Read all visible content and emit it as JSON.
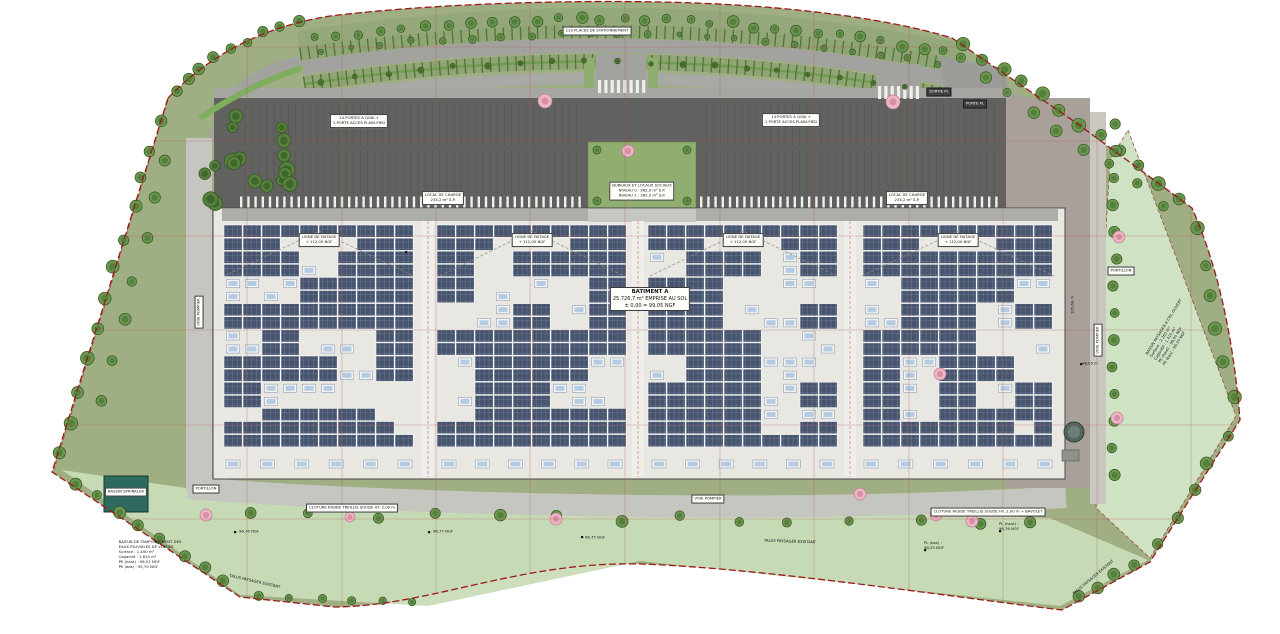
{
  "colors": {
    "boundary_red": "#9b1b1b",
    "survey_grid_red": "#b05454",
    "lawn_green": "#9fae83",
    "swale_green": "#c9dcb8",
    "tree_green": "#6b9750",
    "hedge_green": "#7fae5f",
    "pink_tree": "#edb6c4",
    "asphalt_parking": "#a2a29e",
    "truck_court_dark": "#616160",
    "road_light": "#c6c6c0",
    "roof_light": "#e8e7e2",
    "solar_panel_blue": "#47546e",
    "skylight_blue": "#b5cbe2",
    "basin_teal": "#2e6b5e"
  },
  "parking": {
    "label": "119 PLACES DE STATIONNEMENT"
  },
  "court": {
    "dock_left_line1": "14 PORTES A QUAI +",
    "dock_left_line2": "1 PORTE ACCES PLAIN-PIED",
    "dock_right_line1": "14 PORTES A QUAI +",
    "dock_right_line2": "1 PORTE ACCES PLAIN-PIED",
    "gate_exit": "SORTIE PL",
    "gate_entry": "PORTE PL"
  },
  "building": {
    "name": "BATIMENT A",
    "area": "25.726,7 m² EMPRISE AU SOL",
    "level": "± 0,00 = 99,05 NGF",
    "offices_line1": "BUREAUX ET LOCAUX SOCIAUX",
    "offices_line2": "NIVEAU 0 : 362,0 m² S.P.",
    "offices_line3": "NIVEAU 1 : 362,0 m² S.P.",
    "charge_line1": "LOCAL DE CHARGE",
    "charge_line2": "234,2 m² S.P.",
    "ridge_line1": "LIGNE DE FAITAGE",
    "ridge_line2": "+ 112,00 NGF"
  },
  "roads": {
    "fire_lane": "VOIE POMPIER"
  },
  "landscape": {
    "talus": "TALUS PAYSAGER EXISTANT",
    "portillon": "PORTILLON",
    "sprinkler_tank": "BASSIN SPRINKLER",
    "fence_left": "CLOTURE RIGIDE TREILLIS SOUDE HT. 2,00 m",
    "fence_right": "CLOTURE RIGIDE TREILLIS SOUDE HT. 2,00 m + BAVOLET"
  },
  "basin_left": {
    "l1": "BASSIN DE TAMPONNEMENT DES",
    "l2": "EAUX PLUVIALES DE VOIRIES",
    "l3": "Surface : 1.450 m²",
    "l4": "Capacité : 1.610 m³",
    "l5": "PE (haut) : 96,51 NGF",
    "l6": "PE (bas) : 95,70 NGF"
  },
  "basin_right": {
    "l1": "BASSIN PAYSAGER A CIEL OUVERT",
    "l2": "Surface : 2.260 m²",
    "l3": "Capacité : 1.410 m³",
    "l4": "PE (haut) : 96,90 NGF",
    "l5": "PE (bas) : 96,20 NGF"
  },
  "levels": {
    "e1": "96,76 NGF",
    "e2": "96,77 NGF",
    "e3": "96,75 NGF",
    "pl_bas": "PL (bas) :",
    "pl_bas_v": "98,33 NGF",
    "pl_haut": "PL (haut) :",
    "pl_haut_v": "96,76 NGF",
    "dim_right": "105,68 m",
    "dim_right2": "98,05 m"
  }
}
